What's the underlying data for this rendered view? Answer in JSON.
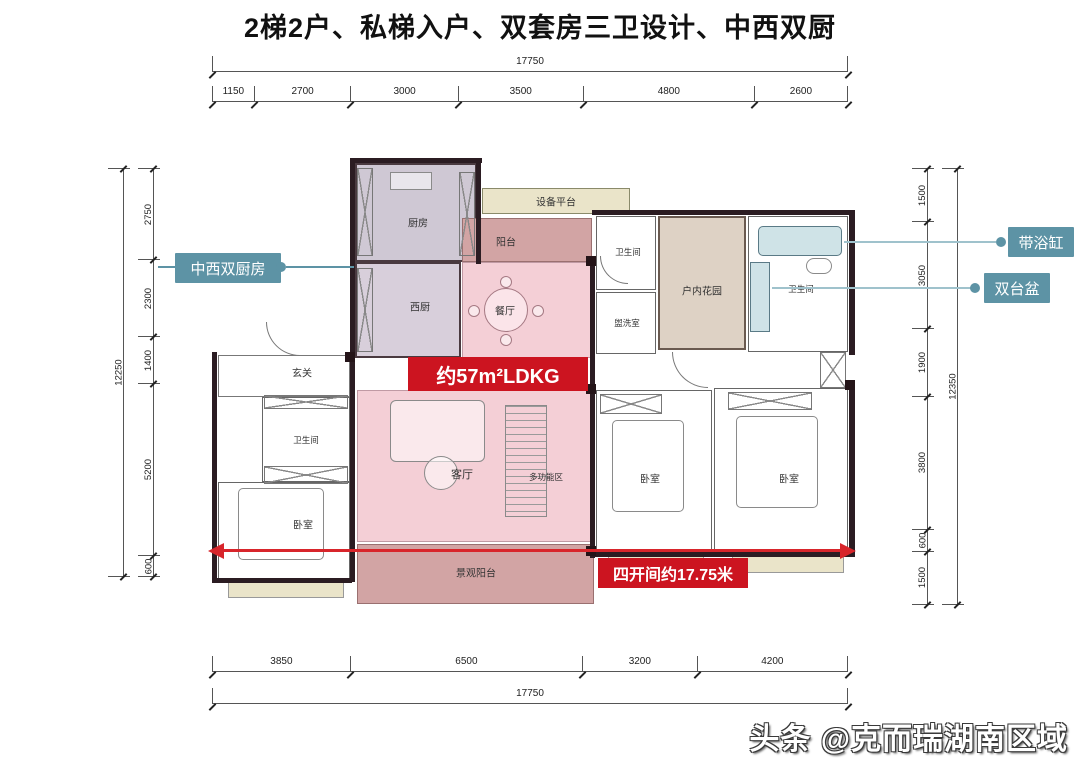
{
  "title": "2梯2户、私梯入户、双套房三卫设计、中西双厨",
  "watermark": "头条 @克而瑞湖南区域",
  "dimensions": {
    "top": {
      "total": "17750",
      "segments": [
        "1150",
        "2700",
        "3000",
        "3500",
        "4800",
        "2600"
      ]
    },
    "bottom": {
      "total": "17750",
      "segments": [
        "3850",
        "6500",
        "3200",
        "4200"
      ]
    },
    "left": {
      "total": "12250",
      "segments": [
        "2750",
        "2300",
        "1400",
        "5200",
        "600"
      ]
    },
    "right": {
      "total": "12350",
      "segments": [
        "1500",
        "3050",
        "1900",
        "3800",
        "600",
        "1500"
      ]
    }
  },
  "rooms": {
    "kitchen": "厨房",
    "equipment_platform": "设备平台",
    "balcony_north": "阳台",
    "west_kitchen": "西厨",
    "dining": "餐厅",
    "foyer": "玄关",
    "bath_left": "卫生间",
    "bath_mid": "卫生间",
    "bath_right": "卫生间",
    "laundry": "盥洗室",
    "indoor_garden": "户内花园",
    "living": "客厅",
    "multi_zone": "多功能区",
    "bedroom_left": "卧室",
    "bedroom_mid": "卧室",
    "bedroom_right": "卧室",
    "view_balcony": "景观阳台"
  },
  "badges": {
    "ldkg": "约57m²LDKG",
    "span": "四开间约17.75米"
  },
  "callouts": {
    "dual_kitchen": "中西双厨房",
    "bathtub": "带浴缸",
    "double_basin": "双台盆"
  },
  "colors": {
    "accent_red": "#cc1420",
    "arrow_red": "#d8252b",
    "callout_teal": "#5d93a5",
    "ldkg_pink": "#f4cfd6",
    "balcony_rose": "#d2a4a4",
    "platform_cream": "#eae4c9",
    "kitchen_lavender": "#cfc8d4",
    "garden_tan": "#ded2c5",
    "bath_blue": "#cfe3e7",
    "wall_dark": "#2b1c22"
  }
}
